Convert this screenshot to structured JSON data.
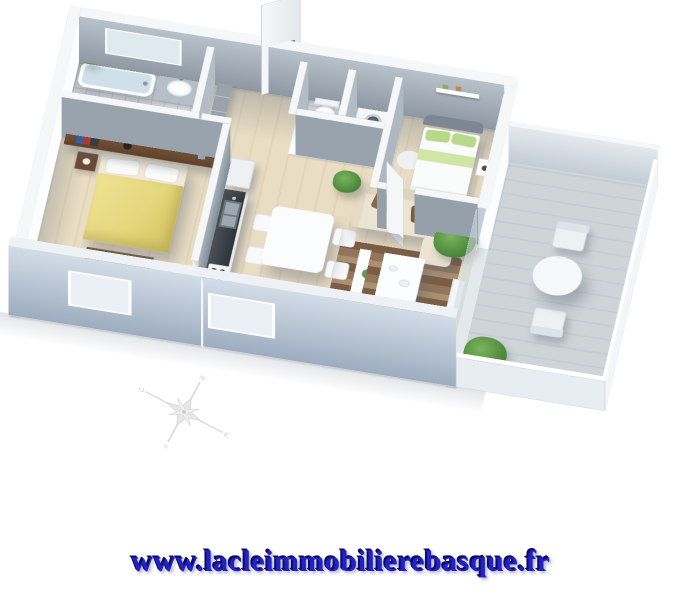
{
  "footer": {
    "url": "www.lacleimmobilierebasque.fr",
    "text_color": "#2222cc",
    "shadow_color": "#0c0c5e"
  },
  "compass": {
    "labels": {
      "north": "N",
      "east": "E",
      "south": "S",
      "west": "O"
    },
    "color": "#d4d4d4"
  },
  "floorplan": {
    "type": "3d-isometric-apartment-render",
    "colors": {
      "background": "#ffffff",
      "wood_floor": "#e7dcc3",
      "tile_floor": "#f4f5f6",
      "terrace_floor": "#cfd4d9",
      "walls_top": "#f5f7f9",
      "wall_inner_face": "#97a1ab",
      "facade_face": "#b7c3d3",
      "bed1_duvet": "#e9dc86",
      "bed2_accent": "#b9d98a",
      "sofa": "#ece4d2",
      "cushion": "#8a684c",
      "rug": "#7b5d43",
      "plant": "#4e8a3c",
      "furniture_wood": "#6b4a33"
    },
    "rooms": [
      {
        "name": "bathroom",
        "furniture": [
          "bathtub",
          "washbasin-vanity",
          "ledge-plant"
        ]
      },
      {
        "name": "entrance-hall",
        "furniture": [
          "entrance-door",
          "wardrobe"
        ]
      },
      {
        "name": "wc",
        "furniture": [
          "toilet"
        ]
      },
      {
        "name": "laundry-closet",
        "furniture": [
          "washing-machine"
        ]
      },
      {
        "name": "bedroom-2",
        "furniture": [
          "double-bed",
          "headboard",
          "nightstand",
          "round-rug",
          "round-rug",
          "wall-shelf",
          "open-door"
        ]
      },
      {
        "name": "bedroom-1",
        "furniture": [
          "double-bed-yellow",
          "headboard-shelf-with-books",
          "nightstand",
          "foot-bench",
          "open-door"
        ]
      },
      {
        "name": "kitchen",
        "furniture": [
          "tall-cabinet",
          "counter",
          "double-sink",
          "cooktop"
        ]
      },
      {
        "name": "living-dining",
        "furniture": [
          "dining-table",
          "chair",
          "chair",
          "chair",
          "chair",
          "sofa",
          "cushions",
          "striped-rug",
          "coffee-table",
          "pouf",
          "tv-unit",
          "potted-plant",
          "potted-plant",
          "potted-plant"
        ]
      },
      {
        "name": "terrace",
        "furniture": [
          "round-table",
          "chair",
          "chair",
          "potted-plant",
          "glass-balustrade"
        ]
      }
    ]
  }
}
